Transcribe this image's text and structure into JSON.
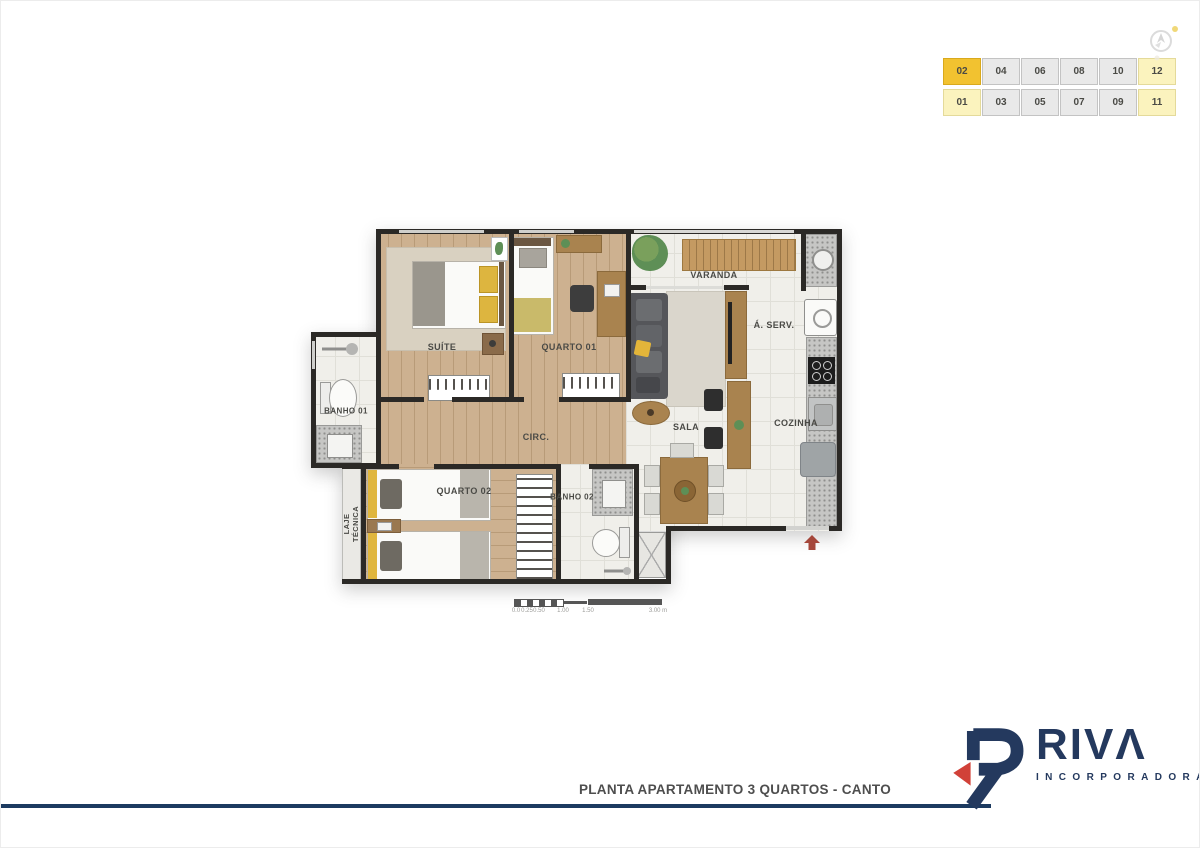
{
  "page": {
    "background": "#ffffff"
  },
  "unit_grid": {
    "rows": [
      [
        "02",
        "04",
        "06",
        "08",
        "10",
        "12"
      ],
      [
        "01",
        "03",
        "05",
        "07",
        "09",
        "11"
      ]
    ],
    "selected_unit": "02",
    "corner_units": [
      "01",
      "11",
      "12"
    ],
    "colors": {
      "selected": "#F2C230",
      "corner": "#FBF3BE",
      "default": "#E9E9E9",
      "text": "#4A4A45"
    }
  },
  "floor_plan": {
    "rooms": [
      {
        "id": "suite",
        "label": "SUÍTE"
      },
      {
        "id": "quarto-01",
        "label": "QUARTO 01"
      },
      {
        "id": "varanda",
        "label": "VARANDA"
      },
      {
        "id": "area-servico",
        "label": "Á. SERV."
      },
      {
        "id": "sala",
        "label": "SALA"
      },
      {
        "id": "cozinha",
        "label": "COZINHA"
      },
      {
        "id": "circulacao",
        "label": "CIRC."
      },
      {
        "id": "banho-01",
        "label": "BANHO 01"
      },
      {
        "id": "quarto-02",
        "label": "QUARTO 02"
      },
      {
        "id": "banho-02",
        "label": "BANHO 02"
      },
      {
        "id": "laje-tecnica",
        "label": "LAJE TÉCNICA"
      }
    ],
    "wall_color": "#2B2926",
    "entrance_arrow_color": "#A5473B"
  },
  "scale_bar": {
    "ticks": [
      "0.0",
      "0.25",
      "0.50",
      "1.00",
      "1.50",
      "3.00 m"
    ]
  },
  "footer": {
    "title": "PLANTA APARTAMENTO 3 QUARTOS - CANTO",
    "line_color": "#1C3A60"
  },
  "logo": {
    "wordmark": "RIVΛ",
    "subtitle": "INCORPORADORA",
    "navy": "#24395E",
    "red": "#D14138"
  }
}
